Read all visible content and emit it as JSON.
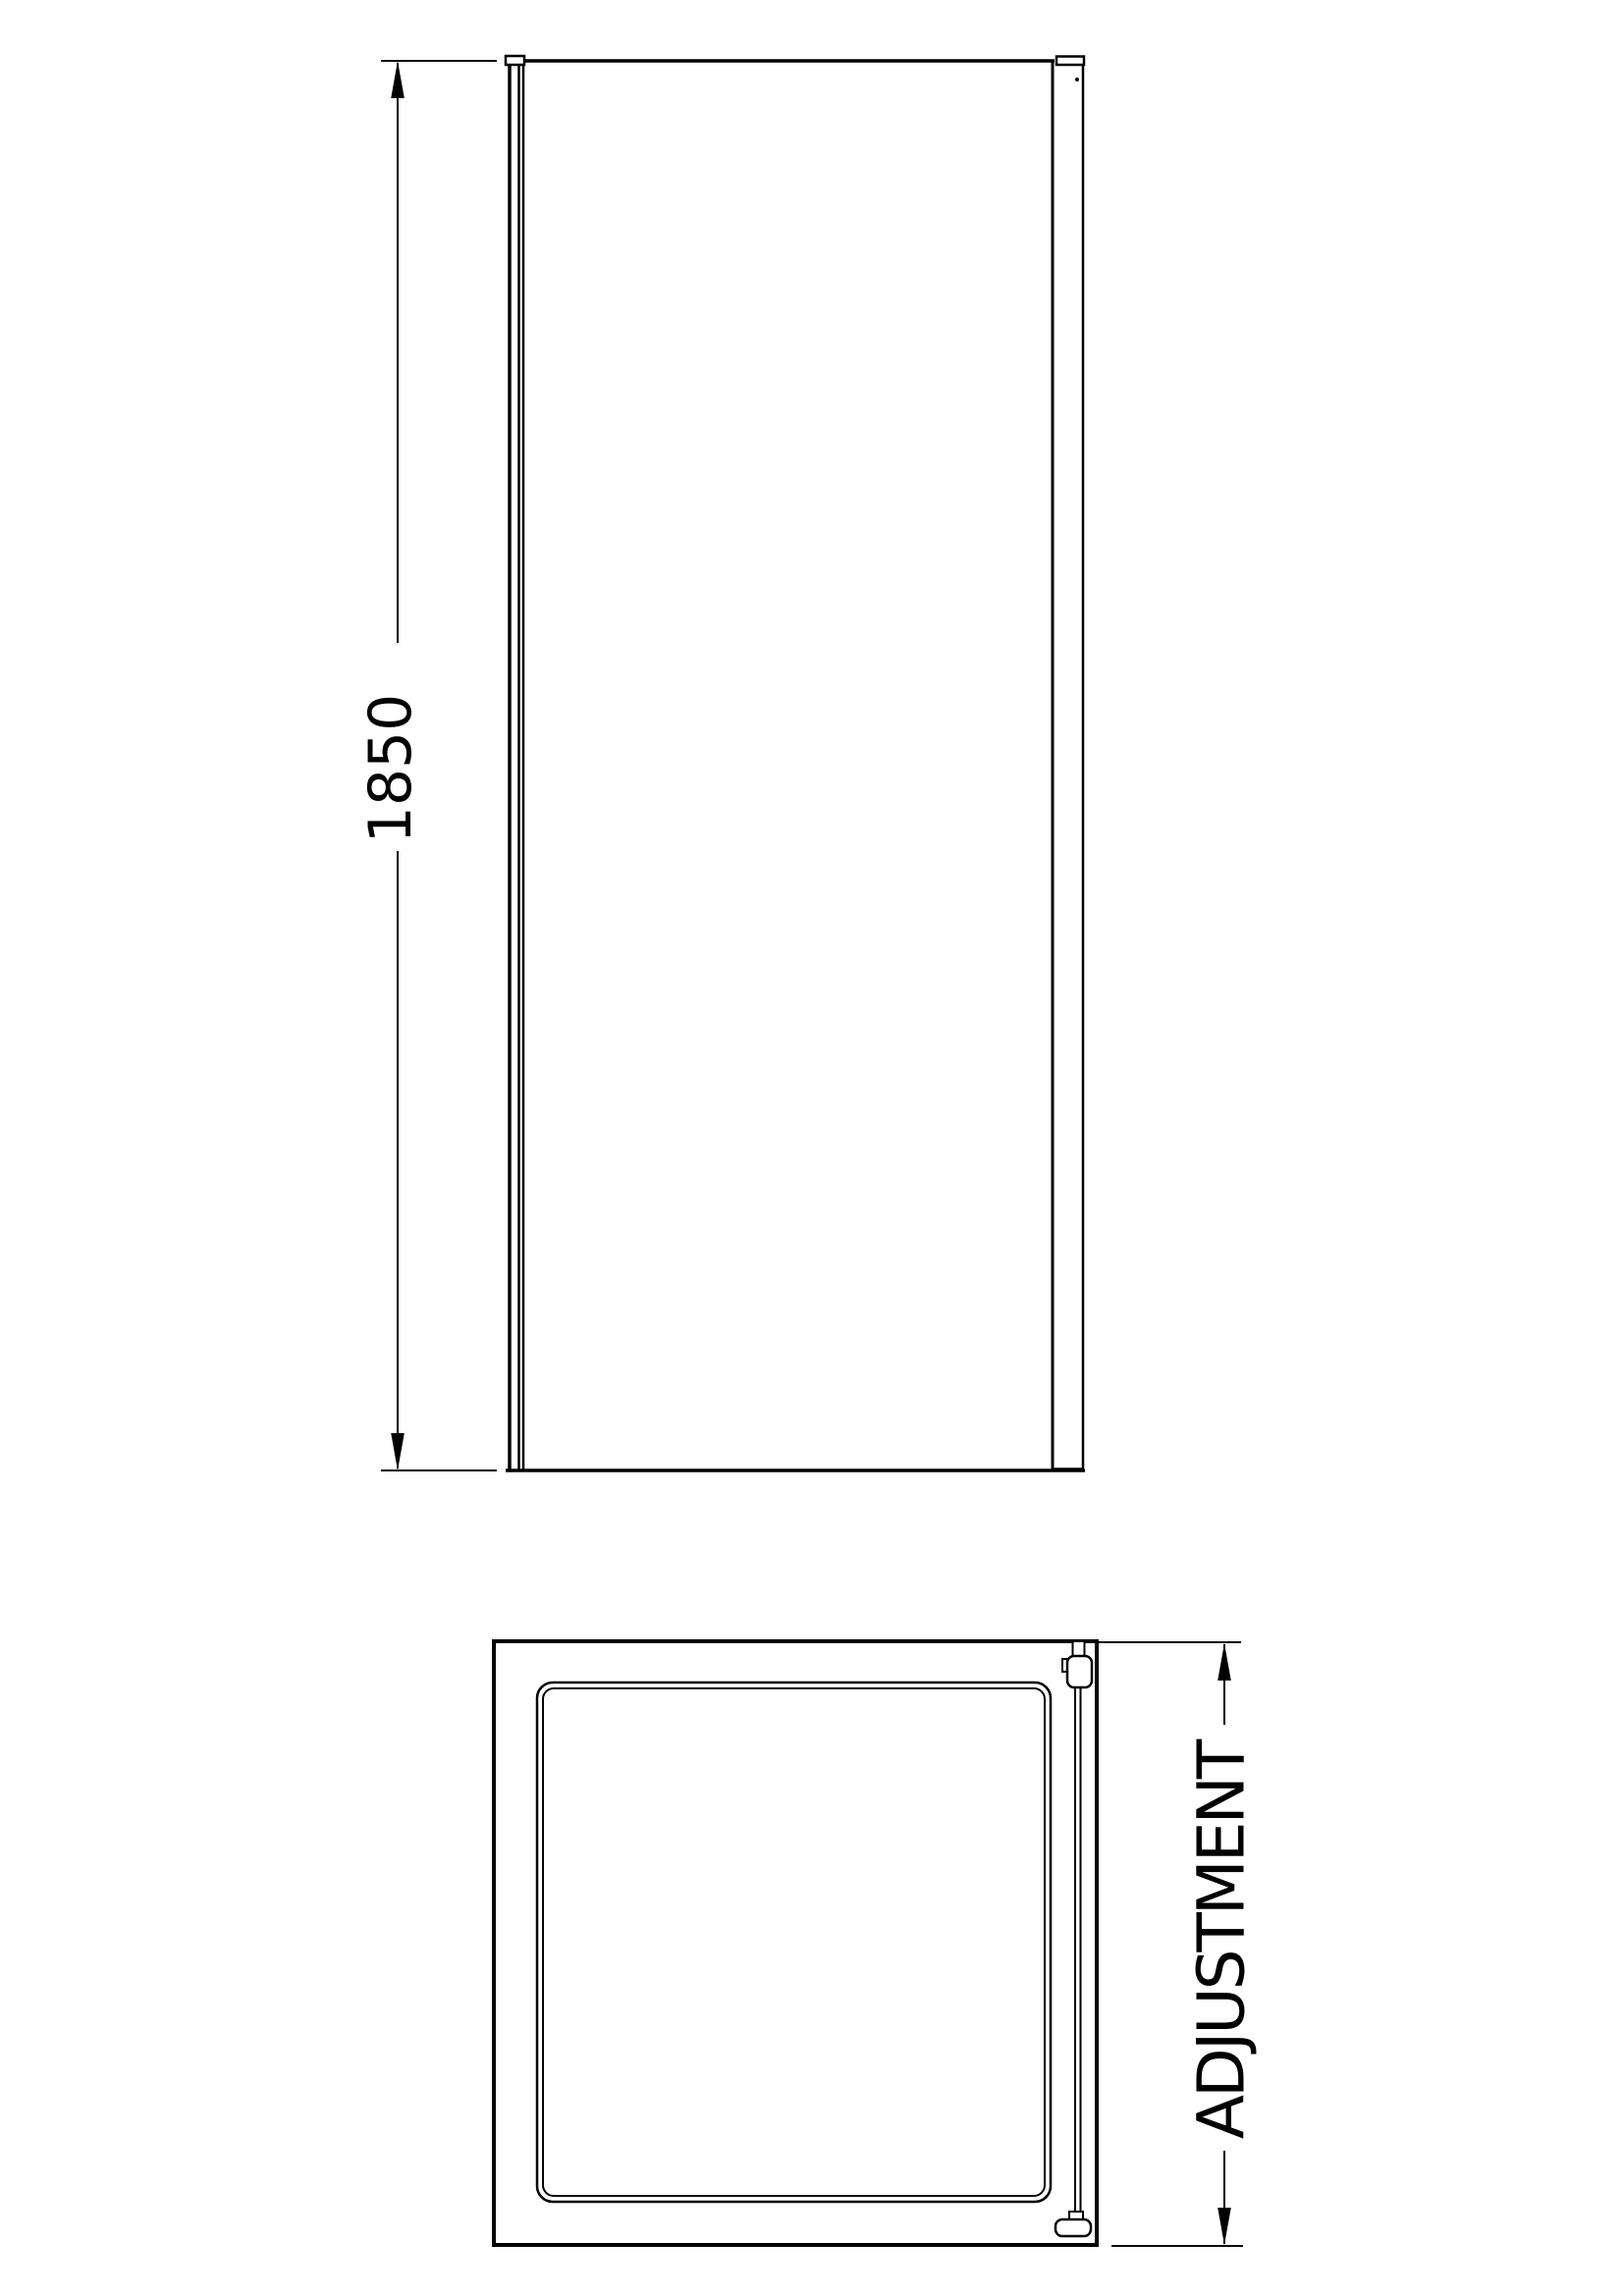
{
  "page": {
    "background_color": "#ffffff",
    "line_color": "#010101"
  },
  "elevation_view": {
    "height_dimension": {
      "label": "1850"
    }
  },
  "plan_view": {
    "width_dimension": {
      "label": "ADJUSTMENT"
    }
  }
}
